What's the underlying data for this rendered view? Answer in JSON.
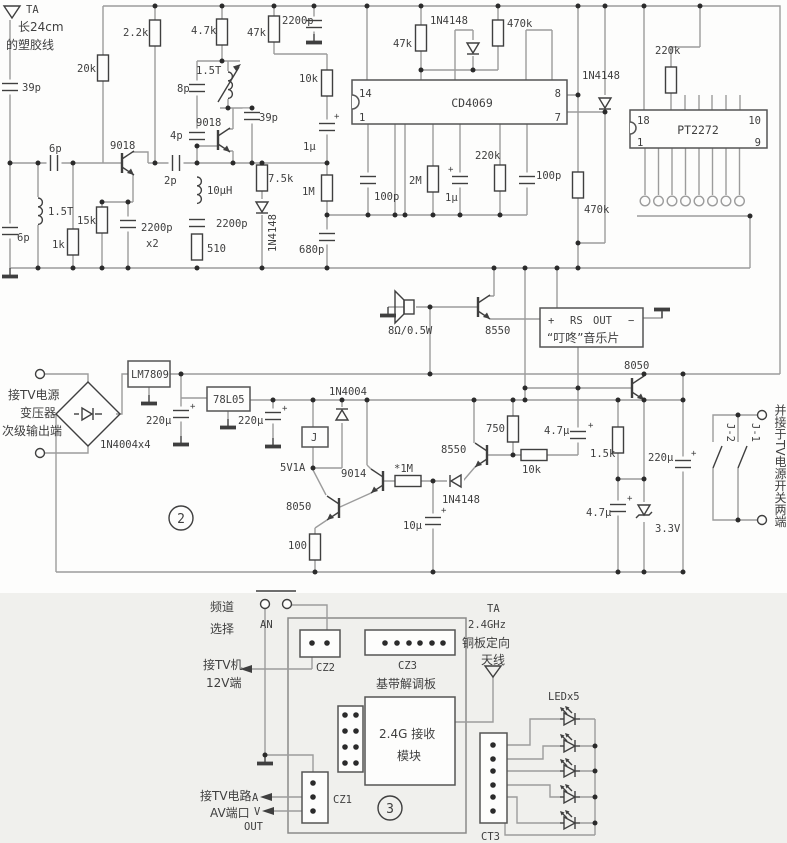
{
  "doc": {
    "kind": "circuit-schematic"
  },
  "colors": {
    "paper": "#fdfdfc",
    "paper_lower": "#f0f0ed",
    "wire_gray": "#9c9c9c",
    "ink": "#3f3f3f"
  },
  "sym": {
    "plus": "+"
  },
  "s1": {
    "ant_ta": "TA",
    "ant_note1": "长24cm",
    "ant_note2": "的塑胶线",
    "c39p_l": "39p",
    "c6p_ser": "6p",
    "l15t_l": "1.5T",
    "c6p_b": "6p",
    "r1k": "1k",
    "r15k": "15k",
    "r20k": "20k",
    "r2k2": "2.2k",
    "q1": "9018",
    "c2200_x2a": "2200p",
    "c2200_x2b": "x2",
    "c2p": "2p",
    "l10uh": "10µH",
    "r510": "510",
    "c2200_2": "2200p",
    "c4p": "4p",
    "c8p": "8p",
    "l15t_r": "1.5T",
    "q2": "9018",
    "c39p_r": "39p",
    "r7k5": "7.5k",
    "d1": "1N4148",
    "r4k7": "4.7k",
    "r47k_t": "47k",
    "c2200_t": "2200p",
    "r10k": "10k",
    "c1u_a": "1µ",
    "r1m": "1M",
    "c680p": "680p",
    "r47k_b": "47k",
    "d2": "1N4148",
    "r470k_a": "470k",
    "ic1": "CD4069",
    "p14": "14",
    "p1": "1",
    "p8": "8",
    "p7": "7",
    "c100p_a": "100p",
    "r2m": "2M",
    "c1u_b": "1µ",
    "r220k_a": "220k",
    "c100p_b": "100p",
    "r470k_b": "470k",
    "d3": "1N4148",
    "r220k_b": "220k",
    "ic2": "PT2272",
    "p18": "18",
    "p1b": "1",
    "p10": "10",
    "p9": "9"
  },
  "music": {
    "spk": "8Ω/0.5W",
    "q3": "8550",
    "plus": "+",
    "rs": "RS",
    "out": "OUT",
    "minus": "−",
    "name": "“叮咚”音乐片",
    "q4": "8050"
  },
  "power": {
    "in1": "接TV电源",
    "in2": "变压器",
    "in3": "次级输出端",
    "bridge": "1N4004x4",
    "reg1": "LM7809",
    "c220u_a": "220µ",
    "reg2": "78L05",
    "c220u_b": "220µ",
    "d4": "1N4004",
    "relay": "J",
    "relay_spec": "5V1A",
    "q5": "8050",
    "r100": "100",
    "q6": "9014",
    "r1m_s": "*1M",
    "d5": "1N4148",
    "c10u": "10µ",
    "q7": "8550",
    "r750": "750",
    "r10k": "10k",
    "c4u7_a": "4.7µ",
    "r1k5": "1.5k",
    "c220u_c": "220µ",
    "c4u7_b": "4.7µ",
    "dz": "3.3V",
    "sec": "2",
    "j1": "J-1",
    "j2": "J-2",
    "note": "并接于TV电源开关两端"
  },
  "rx": {
    "ch1": "频道",
    "ch2": "选择",
    "an": "AN",
    "tv1": "接TV机",
    "tv2": "12V端",
    "cz2": "CZ2",
    "cz3": "CZ3",
    "board": "基带解调板",
    "mod1": "2.4G 接收",
    "mod2": "模块",
    "av1": "接TV电路",
    "av2": "AV端口",
    "a": "A",
    "v": "V",
    "out": "OUT",
    "cz1": "CZ1",
    "sec": "3",
    "ant1": "TA",
    "ant2": "2.4GHz",
    "ant3": "铜板定向",
    "ant4": "天线",
    "led": "LEDx5",
    "ct3": "CT3"
  }
}
